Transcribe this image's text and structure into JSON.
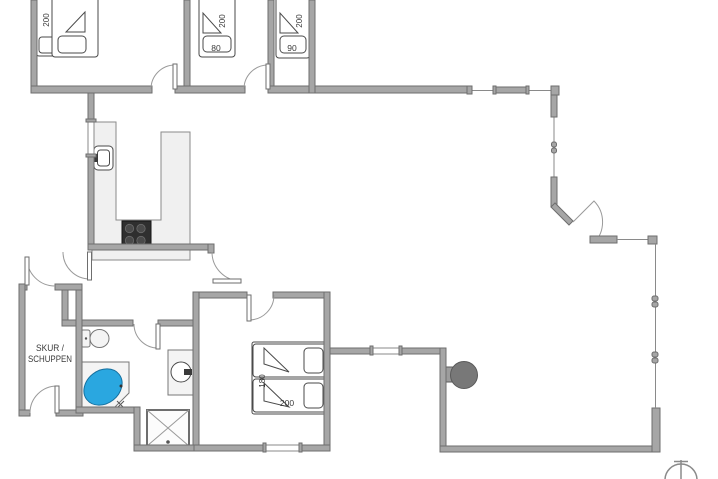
{
  "floor_plan": {
    "rooms": {
      "bedroom_top_left": {
        "bed_length": "200"
      },
      "bedroom_top_middle": {
        "bed_length": "200",
        "bed_width": "80"
      },
      "bedroom_top_right": {
        "bed_length": "200",
        "bed_width": "90"
      },
      "bedroom_master": {
        "bed_length": "200",
        "bed_width": "180"
      },
      "shed": {
        "label_line1": "SKUR /",
        "label_line2": "SCHUPPEN"
      }
    },
    "fixtures": [
      "kitchen-counter",
      "sink",
      "cooktop",
      "toilet",
      "corner-bathtub",
      "washbasin",
      "shower",
      "grill",
      "north-arrow"
    ],
    "colors": {
      "wall": "#a6a6a6",
      "wall_edge": "#6e6e6e",
      "counter": "#f0f0f0",
      "bathtub_blue": "#2aa7e0",
      "cooktop_dark": "#2f2f2f",
      "grill_gray": "#787878",
      "line_gray": "#8a8a8a",
      "text": "#3a3a3a",
      "background": "#ffffff"
    }
  }
}
